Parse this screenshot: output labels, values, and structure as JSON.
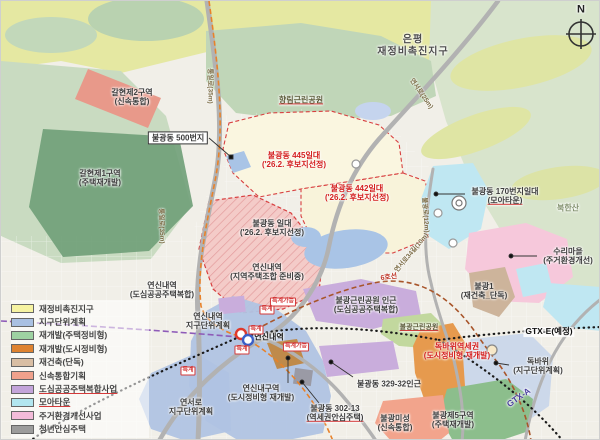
{
  "title": {
    "line1": "은평",
    "line2": "재정비촉진지구"
  },
  "compass": {
    "label": "N"
  },
  "legend": {
    "items": [
      {
        "label": "재정비촉진지구",
        "color": "#f6f3a2"
      },
      {
        "label": "지구단위계획",
        "color": "#a9c0e2"
      },
      {
        "label": "재개발(주택정비형)",
        "color": "#9ed2a2"
      },
      {
        "label": "재개발(도시정비형)",
        "color": "#de8230"
      },
      {
        "label": "재건축(단독)",
        "color": "#d9bea4"
      },
      {
        "label": "신속통합기획",
        "color": "#f0a18c"
      },
      {
        "label": "도심공공주택복합사업",
        "color": "#c3a4da"
      },
      {
        "label": "모아타운",
        "color": "#b2e6f0"
      },
      {
        "label": "주거환경개선사업",
        "color": "#f3bbd9"
      },
      {
        "label": "청년안심주택",
        "color": "#9c9c9c"
      }
    ]
  },
  "map_labels": {
    "galhyeon2": {
      "name": "갈현제2구역",
      "sub": "(신속통합)"
    },
    "bulgwang500": {
      "name": "불광동 500번지"
    },
    "galhyeon1": {
      "name": "갈현제1구역",
      "sub": "(주택재개발)"
    },
    "hyanglim_park": {
      "name": "향림근린공원"
    },
    "bulgwang445": {
      "name": "불광동 445일대",
      "sub": "('26.2. 후보지선정)"
    },
    "bulgwang442": {
      "name": "불광동 442일대",
      "sub": "('26.2. 후보지선정)"
    },
    "bulgwang_ildae": {
      "name": "불광동 일대",
      "sub": "('26.2. 후보지선정)"
    },
    "bulgwang170": {
      "name": "불광동 170번지일대",
      "sub": "(모아타운)"
    },
    "bukhansan": {
      "name": "북한산"
    },
    "suri_village": {
      "name": "수리마을",
      "sub": "(주거환경개선)"
    },
    "yeonsinnae_johap": {
      "name": "연신내역",
      "sub": "(지역주택조합 준비중)"
    },
    "yeonsinnae_public": {
      "name": "연신내역",
      "sub": "(도심공공주택복합)"
    },
    "yeonsinnae_plan": {
      "name": "연신내역",
      "sub": "지구단위계획"
    },
    "yeonsinnae_station": {
      "name": "연신내역"
    },
    "bulgwang_park_near": {
      "name": "불광근린공원 인근",
      "sub": "(도심공공주택복합)"
    },
    "bulgwang_park": {
      "name": "불광근린공원"
    },
    "bulgwang1": {
      "name": "불광1",
      "sub": "(재건축_단독)"
    },
    "gtx_e": {
      "name": "GTX-E(예정)"
    },
    "dokbawi_area": {
      "name": "독바위역세권",
      "sub": "(도시정비형 재개발)"
    },
    "dokbawi": {
      "name": "독바위",
      "sub": "(지구단위계획)"
    },
    "gtx_a": {
      "name": "GTX-A"
    },
    "yeonsinnae_guyeok": {
      "name": "연신내구역",
      "sub": "(도시정비형 재개발)"
    },
    "yeonseo_plan": {
      "name": "연서로",
      "sub": "지구단위계획"
    },
    "bulgwang329": {
      "name": "불광동 329-32인근"
    },
    "bulgwang302": {
      "name": "불광동 302-13",
      "sub": "(역세권안심주택)"
    },
    "bulgwang_miseong": {
      "name": "불광미성",
      "sub": "(신속통합)"
    },
    "bulgwang5": {
      "name": "불광제5구역",
      "sub": "(주택재개발)"
    },
    "line6": {
      "name": "6호선"
    }
  },
  "road_labels": {
    "tongil_top": "통일로(35m)",
    "tongil_mid": "통일로(35m)",
    "yeonseo": "연서로(25m)",
    "bulgwang_ro": "불광로(12m)",
    "yeonseo34": "연서로34길(10m)"
  },
  "special_tags": {
    "teukgye": "특계",
    "teukgye_ga": "특계가능"
  }
}
